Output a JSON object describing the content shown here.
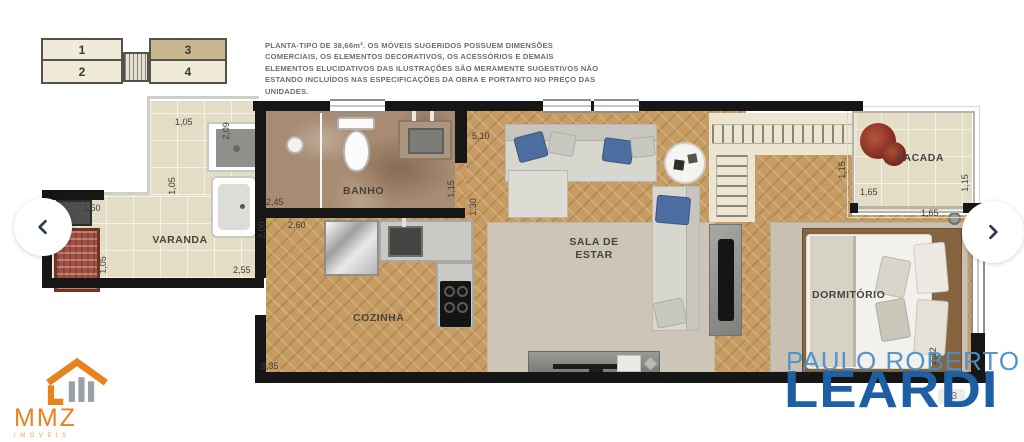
{
  "colors": {
    "wall": "#161616",
    "floor_wood": "#c69c62",
    "floor_tile": "#e4ddc6",
    "floor_marble": "#a78b72",
    "brand_blue": "#1c5fa5",
    "brand_light_blue": "#4b8fca",
    "logo_orange": "#e8821e",
    "pillow_blue": "#4d6da0",
    "keyplan_highlight": "#c7b68e"
  },
  "keyplan": {
    "units": [
      {
        "n": "1"
      },
      {
        "n": "2"
      },
      {
        "n": "3"
      },
      {
        "n": "4"
      }
    ],
    "highlighted_unit": "3"
  },
  "disclaimer": {
    "text": "PLANTA-TIPO DE 38,66m². OS MÓVEIS SUGERIDOS POSSUEM DIMENSÕES COMERCIAIS, OS ELEMENTOS DECORATIVOS, OS ACESSÓRIOS E DEMAIS ELEMENTOS ELUCIDATIVOS DAS ILUSTRAÇÕES SÃO MERAMENTE SUGESTIVOS NÃO ESTANDO INCLUÍDOS NAS ESPECIFICAÇÕES DA OBRA E PORTANTO NO PREÇO DAS UNIDADES."
  },
  "plan": {
    "rooms": {
      "varanda": "VARANDA",
      "banho": "BANHO",
      "cozinha": "COZINHA",
      "sala": "SALA DE ESTAR",
      "dormitorio": "DORMITÓRIO",
      "sacada": "SACADA"
    },
    "dimensions": [
      {
        "v": "1,05",
        "loc": "varanda-top-width"
      },
      {
        "v": "2,09",
        "loc": "varanda-tank-depth"
      },
      {
        "v": "1,05",
        "loc": "varanda-mid-depth"
      },
      {
        "v": "1,50",
        "loc": "varanda-grill-width"
      },
      {
        "v": "1,05",
        "loc": "varanda-left-depth"
      },
      {
        "v": "2,55",
        "loc": "varanda-bottom-width"
      },
      {
        "v": "2,45",
        "loc": "banho-width"
      },
      {
        "v": "1,15",
        "loc": "banho-right-depth"
      },
      {
        "v": "1,30",
        "loc": "hall-depth"
      },
      {
        "v": "5,10",
        "loc": "sala-width"
      },
      {
        "v": "2,00",
        "loc": "cozinha-depth"
      },
      {
        "v": "2,60",
        "loc": "cozinha-width"
      },
      {
        "v": "9,35",
        "loc": "total-length"
      },
      {
        "v": "1,15",
        "loc": "sacada-left-depth"
      },
      {
        "v": "1,65",
        "loc": "sacada-width"
      },
      {
        "v": "1,15",
        "loc": "sacada-right-depth"
      },
      {
        "v": "1,65",
        "loc": "dormitorio-top-width"
      },
      {
        "v": "2,12",
        "loc": "dormitorio-right-depth"
      }
    ]
  },
  "watermark": {
    "line1": "PAULO ROBERTO",
    "line2": "LEARDI"
  },
  "agency": {
    "name": "MMZ",
    "subtitle": "IMÓVEIS"
  },
  "carousel": {
    "prev_icon": "chevron-left",
    "next_icon": "chevron-right"
  },
  "counter": {
    "visible_text": "/ 3"
  }
}
